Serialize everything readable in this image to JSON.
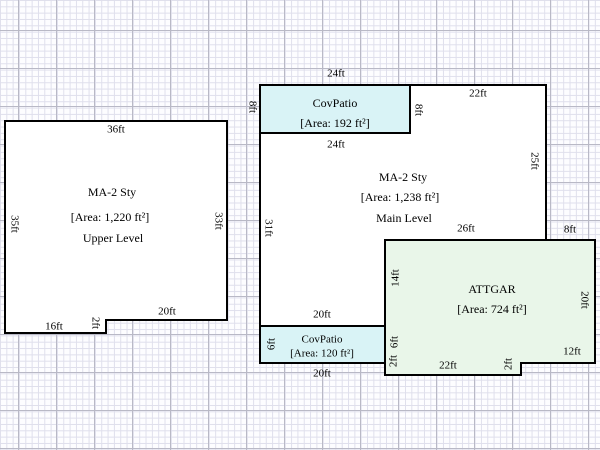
{
  "colors": {
    "outline": "#000000",
    "main_fill": "#ffffff",
    "patio_fill": "#d9f3f6",
    "garage_fill": "#e9f6e9"
  },
  "sketch": {
    "upper": {
      "title": "MA-2 Sty",
      "area": "[Area: 1,220 ft²]",
      "level": "Upper Level",
      "dim_top": "36ft",
      "dim_right": "33ft",
      "dim_left": "35ft",
      "dim_bottom_right": "20ft",
      "dim_step": "2ft",
      "dim_bottom_left": "16ft"
    },
    "patio_top": {
      "title": "CovPatio",
      "area": "[Area: 192 ft²]",
      "dim_top": "24ft",
      "dim_left": "8ft"
    },
    "main": {
      "title": "MA-2 Sty",
      "area": "[Area: 1,238 ft²]",
      "level": "Main Level",
      "dim_patio_bottom": "24ft",
      "dim_patio_right": "8ft",
      "dim_top_right": "22ft",
      "dim_right": "25ft",
      "dim_left": "31ft",
      "dim_garage_top": "26ft",
      "dim_bottom": "20ft"
    },
    "garage": {
      "title": "ATTGAR",
      "area": "[Area: 724 ft²]",
      "dim_top": "8ft",
      "dim_left": "14ft",
      "dim_right": "20ft",
      "dim_bottom_right": "12ft",
      "dim_step": "2ft",
      "dim_bottom": "22ft",
      "dim_left_mid": "6ft",
      "dim_left_bottom": "2ft"
    },
    "patio_bottom": {
      "title": "CovPatio",
      "area": "[Area: 120 ft²]",
      "dim_left": "6ft",
      "dim_bottom": "20ft"
    }
  }
}
